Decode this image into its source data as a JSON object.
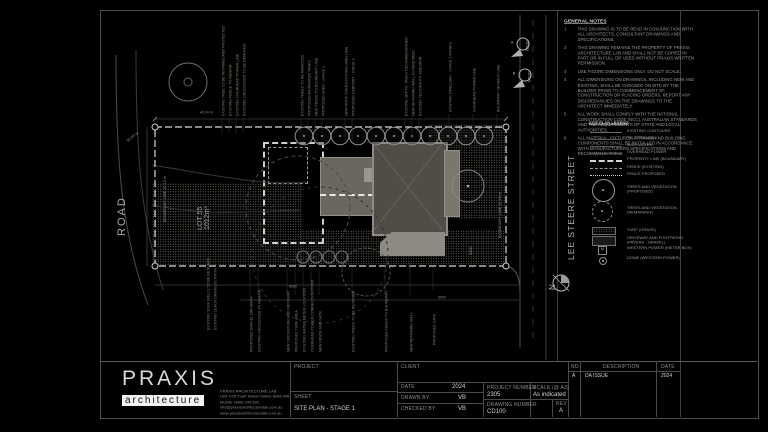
{
  "notes": {
    "title": "GENERAL NOTES",
    "items": [
      {
        "n": "1",
        "text": "THIS DRAWING IS TO BE READ IN CONJUNCTION WITH ALL ARCHITECTS, CONSULTANT DRAWINGS AND SPECIFICATIONS."
      },
      {
        "n": "2",
        "text": "THIS DRAWING REMAINS THE PROPERTY OF PRAXIS ARCHITECTURE LAB AND SHALL NOT BE COPIED IN PART OR IN FULL OR USED WITHOUT PRAXIS WRITTEN PERMISSION."
      },
      {
        "n": "3",
        "text": "USE FIGURE DIMENSIONS ONLY. DO NOT SCALE."
      },
      {
        "n": "4",
        "text": "ALL DIMENSIONS ON DRAWINGS, INCLUDING NEW AND EXISTING, SHALL BE CHECKED ON SITE BY THE BUILDER PRIOR TO COMMENCEMENT OF CONSTRUCTION OR PLACING ORDERS. REPORT ANY DISCREPANCIES ON THE DRAWINGS TO THE ARCHITECT IMMEDIATELY."
      },
      {
        "n": "5",
        "text": "ALL WORK SHALL COMPLY WITH THE NATIONAL CONSTRUCTION CODE (NCC), AUSTRALIAN STANDARDS AND THE REQUIREMENTS OF STATE AND LOCAL AUTHORITIES."
      },
      {
        "n": "6",
        "text": "ALL MATERIAL, FIXTURES, FITTINGS AND BUILDING COMPONENTS SHALL BE INSTALLED IN ACCORDANCE WITH MANUFACTURERS SPECIFICATIONS AND RECOMMENDATIONS."
      }
    ]
  },
  "legend": {
    "title": "SITE PLAN LEGEND",
    "meter_symbol": "M",
    "items": [
      {
        "label": "EXISTING CONTOURS"
      },
      {
        "label": "TELSTRA MAIN"
      },
      {
        "label": "MAIN WATER"
      },
      {
        "label": "OVERHEAD POWER"
      },
      {
        "label": "PROPERTY LINE (BOUNDARY)"
      },
      {
        "label": "FENCE (EXISTING)"
      },
      {
        "label": "FENCE PROPOSED"
      },
      {
        "label": "TREES AND VEGETATION (PROPOSED)"
      },
      {
        "label": "TREES AND VEGETATION (REMAINING)"
      },
      {
        "label": "TURF (GRASS)"
      },
      {
        "label": "DRIVEWAY AND FOOTPATHS (PAVERS - GRAVEL)"
      },
      {
        "label": "WESTERN POWER (METER BOX)"
      },
      {
        "label": "DOME (WESTERN POWER)"
      }
    ]
  },
  "plan": {
    "street": "LEE STEERE STREET",
    "road": "ROAD",
    "north": "N",
    "lot_label": "LOT 55",
    "lot_area": "1012m²",
    "boundary_left": "BOUNDARY LINE  20.12 m",
    "boundary_right": "BOUNDARY LINE  50.29 m",
    "boundary_top_dim": "40.24 m",
    "boundary_diag_dim": "30.03 m",
    "dim_a": "6090",
    "dim_b": "6000",
    "dim_c": "3000",
    "marker_a": {
      "tag": "CD101",
      "letter": "A"
    },
    "marker_b": {
      "tag": "CD101",
      "letter": "B"
    },
    "annotations_top": [
      {
        "text": "EXISTING TREE TO BE RETAINED AND PROTECTED"
      },
      {
        "text": "EXISTING FENCE TO REMAIN"
      },
      {
        "text": "EXISTING OVERHEAD POWER LINE"
      },
      {
        "text": "EXISTING CROSSOVER TO BE REMOVED"
      },
      {
        "text": "EXISTING TREES TO BE REMOVED"
      },
      {
        "text": "PROPOSED RAINWATER TANKS"
      },
      {
        "text": "NEW FENCE TO BOUNDARY LINE"
      },
      {
        "text": "PROPOSED SHED - STAGE 2"
      },
      {
        "text": "NEW ROOF OVER EXISTING DWELLING"
      },
      {
        "text": "PROPOSED CARPORT - STAGE 2"
      },
      {
        "text": "EXISTING SEPTIC TANKS DECOMMISSIONED"
      },
      {
        "text": "NEW RETAINING WALL AS REQUIRED"
      },
      {
        "text": "EXISTING TELSTRA PIT AND MAIN"
      },
      {
        "text": "EXISTING DWELLING - STAGE 1 WORKS"
      },
      {
        "text": "OVERHEAD POWER LINE"
      },
      {
        "text": "BOUNDARY SETBACK LINE"
      }
    ],
    "annotations_bottom": [
      {
        "text": "EXISTING SOAK WELLS TO BE RETAINED"
      },
      {
        "text": "EXISTING LEACH DRAIN LOCATION"
      },
      {
        "text": "PROPOSED GRAVEL DRIVEWAY"
      },
      {
        "text": "EXISTING CROSSOVER TO REMAIN"
      },
      {
        "text": "NEW CROSSOVER AND DRIVEWAY"
      },
      {
        "text": "PROPOSED TURF AREA"
      },
      {
        "text": "EXISTING WATER METER LOCATION"
      },
      {
        "text": "OVERHEAD POWER CONNECTION POINT"
      },
      {
        "text": "NEW FENCE AND GATE"
      },
      {
        "text": "EXISTING TREES TO BE RETAINED"
      },
      {
        "text": "PROPOSED FENCE TO BOUNDARY"
      },
      {
        "text": "NEW RETAINING WALL"
      },
      {
        "text": "PROPOSED GATE"
      }
    ]
  },
  "logo": {
    "brand": "PRAXIS",
    "sub": "architecture",
    "contact": [
      "PRAXIS ARCHITECTURE LAB",
      "Unit 1/25 Tuart Street Yokine 6060 WA",
      "Mobile: 0400 244 592",
      "info@praxisarchitecturelab.com.au",
      "www.praxisarchitecturelab.com.au"
    ]
  },
  "titleblock": {
    "project_label": "PROJECT",
    "sheet_label": "SHEET",
    "sheet_value": "SITE PLAN - STAGE 1",
    "client_label": "CLIENT",
    "date_label": "DATE",
    "date_value": "2024",
    "drawn_label": "DRAWN BY",
    "drawn_value": "VB",
    "checked_label": "CHECKED BY",
    "checked_value": "VB",
    "project_number_label": "PROJECT NUMBER",
    "project_number_value": "2305",
    "drawing_number_label": "DRAWING NUMBER",
    "drawing_number_value": "CD100",
    "scale_label": "SCALE (@ A3)",
    "scale_value": "As indicated",
    "rev_label": "REV",
    "rev_value": "A",
    "revisions": {
      "no_header": "NO",
      "description_header": "DESCRIPTION",
      "date_header": "DATE",
      "rows": [
        {
          "no": "A",
          "description": "DA ISSUE",
          "date": "2024"
        }
      ]
    }
  }
}
